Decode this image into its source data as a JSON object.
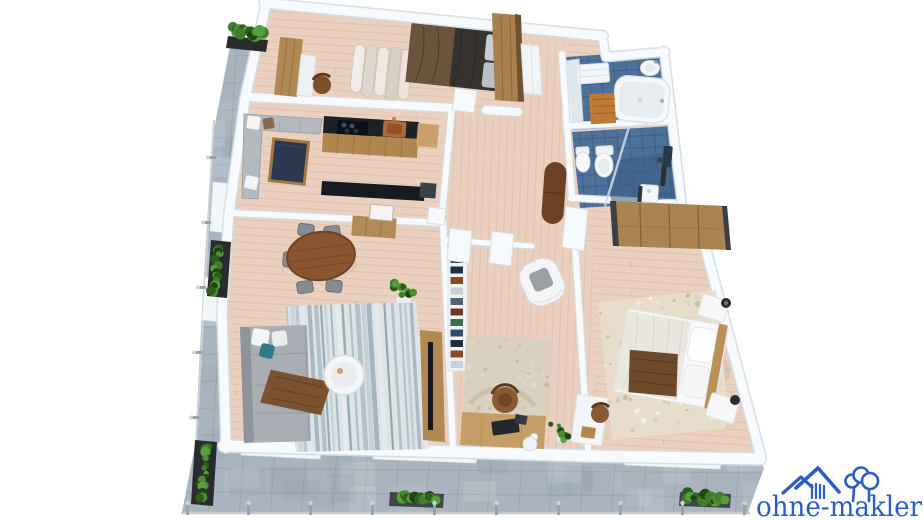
{
  "brand": {
    "name": "ohne-makler",
    "icon": "house-with-trees-icon",
    "color": "#2a5ec4"
  },
  "palette": {
    "background": "#ffffff",
    "terrace_tile": "#a9b4bf",
    "wood_floor": "#ead0be",
    "bathroom_tile": "#4e719a",
    "wall": "#f7fafc",
    "plant_green": "#3f7d2c",
    "wood_furniture": "#b08954",
    "dark_counter": "#1c2128",
    "sofa_gray": "#a9adb4",
    "rug_blue_gray": "#8097a5",
    "rug_beige": "#d9d0bf",
    "bed_white": "#f7f8f9",
    "throw_brown": "#6e4a2c"
  },
  "scene": {
    "kind": "3d-apartment-floor-plan",
    "rooms": [
      "bedroom-1",
      "kitchen",
      "living-dining-room",
      "home-office",
      "hallway",
      "bathroom",
      "wc-bathroom",
      "bedroom-2",
      "terrace"
    ]
  }
}
